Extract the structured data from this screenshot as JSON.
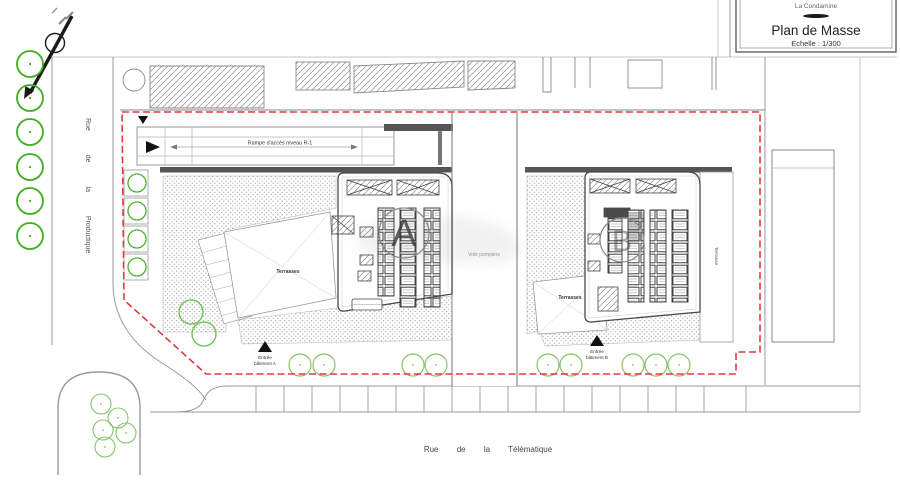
{
  "document": {
    "project": "La Condamine",
    "title": "Plan de Masse",
    "scale": "Echelle : 1/300"
  },
  "streets": {
    "left": "Rue de la Productique",
    "bottom": "Rue de la Télématique"
  },
  "site": {
    "ramp_label": "Rampe d'accès niveau R-1",
    "fire_lane_label": "Voie pompiers",
    "terrace_a_label": "Terrasses",
    "terrace_b_label": "Terrasses",
    "terrace_side_label": "Terrasse",
    "building_a_marker": "A",
    "building_b_marker": "B",
    "entry_a_1": "Entrée",
    "entry_a_2": "bâtiment A",
    "entry_b_1": "Entrée",
    "entry_b_2": "bâtiment B"
  },
  "colors": {
    "boundary_red": "#e23b3b",
    "tree_green": "#3fae1f",
    "tree_light_green": "#86c46a",
    "line_gray": "#8a8a8a",
    "dark_gray": "#4a4a4a"
  }
}
